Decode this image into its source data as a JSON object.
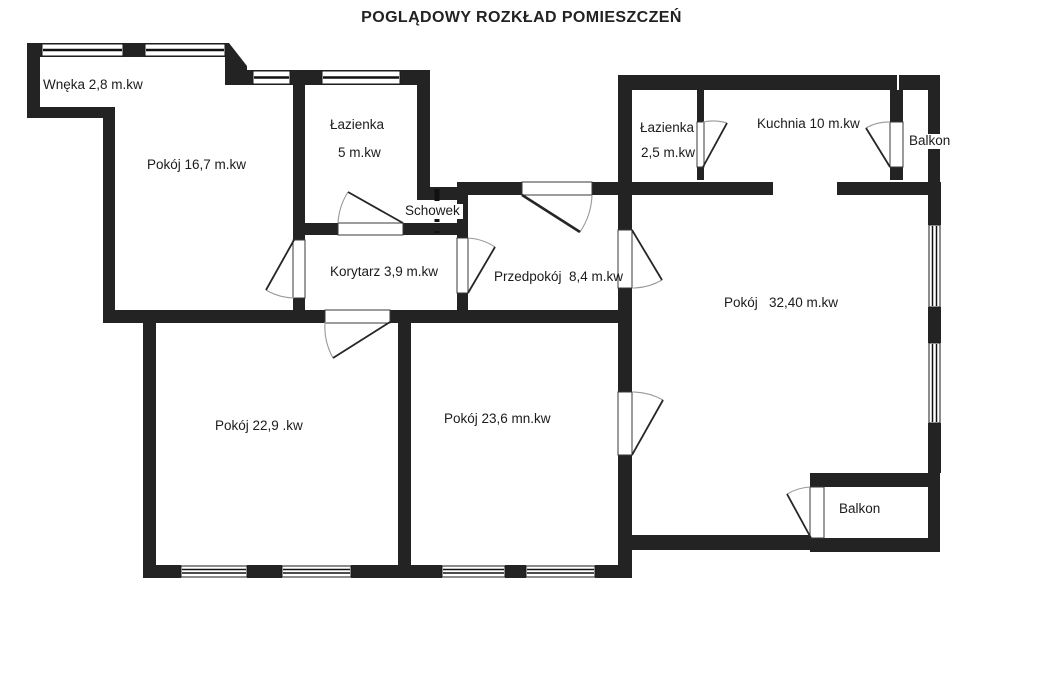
{
  "title": "POGLĄDOWY ROZKŁAD POMIESZCZEŃ",
  "colors": {
    "wall": "#232323",
    "door_arc": "#999999",
    "door_blade": "#262626",
    "text": "#1b1b1b"
  },
  "rooms": {
    "wneka": {
      "label": "Wnęka 2,8 m.kw"
    },
    "pokoj_16_7": {
      "label": "Pokój 16,7 m.kw"
    },
    "lazienka_5": {
      "name": "Łazienka",
      "area": "5 m.kw"
    },
    "schowek": {
      "label": "Schowek"
    },
    "korytarz": {
      "label": "Korytarz 3,9 m.kw"
    },
    "przedpokoj": {
      "label": "Przedpokój  8,4 m.kw"
    },
    "lazienka_2_5": {
      "name": "Łazienka",
      "area": "2,5 m.kw"
    },
    "kuchnia": {
      "label": "Kuchnia 10 m.kw"
    },
    "balkon_gorny": {
      "label": "Balkon"
    },
    "pokoj_32_40": {
      "label": "Pokój   32,40 m.kw"
    },
    "pokoj_22_9": {
      "label": "Pokój 22,9 .kw"
    },
    "pokoj_23_6": {
      "label": "Pokój 23,6 mn.kw"
    },
    "balkon_dolny": {
      "label": "Balkon"
    }
  }
}
